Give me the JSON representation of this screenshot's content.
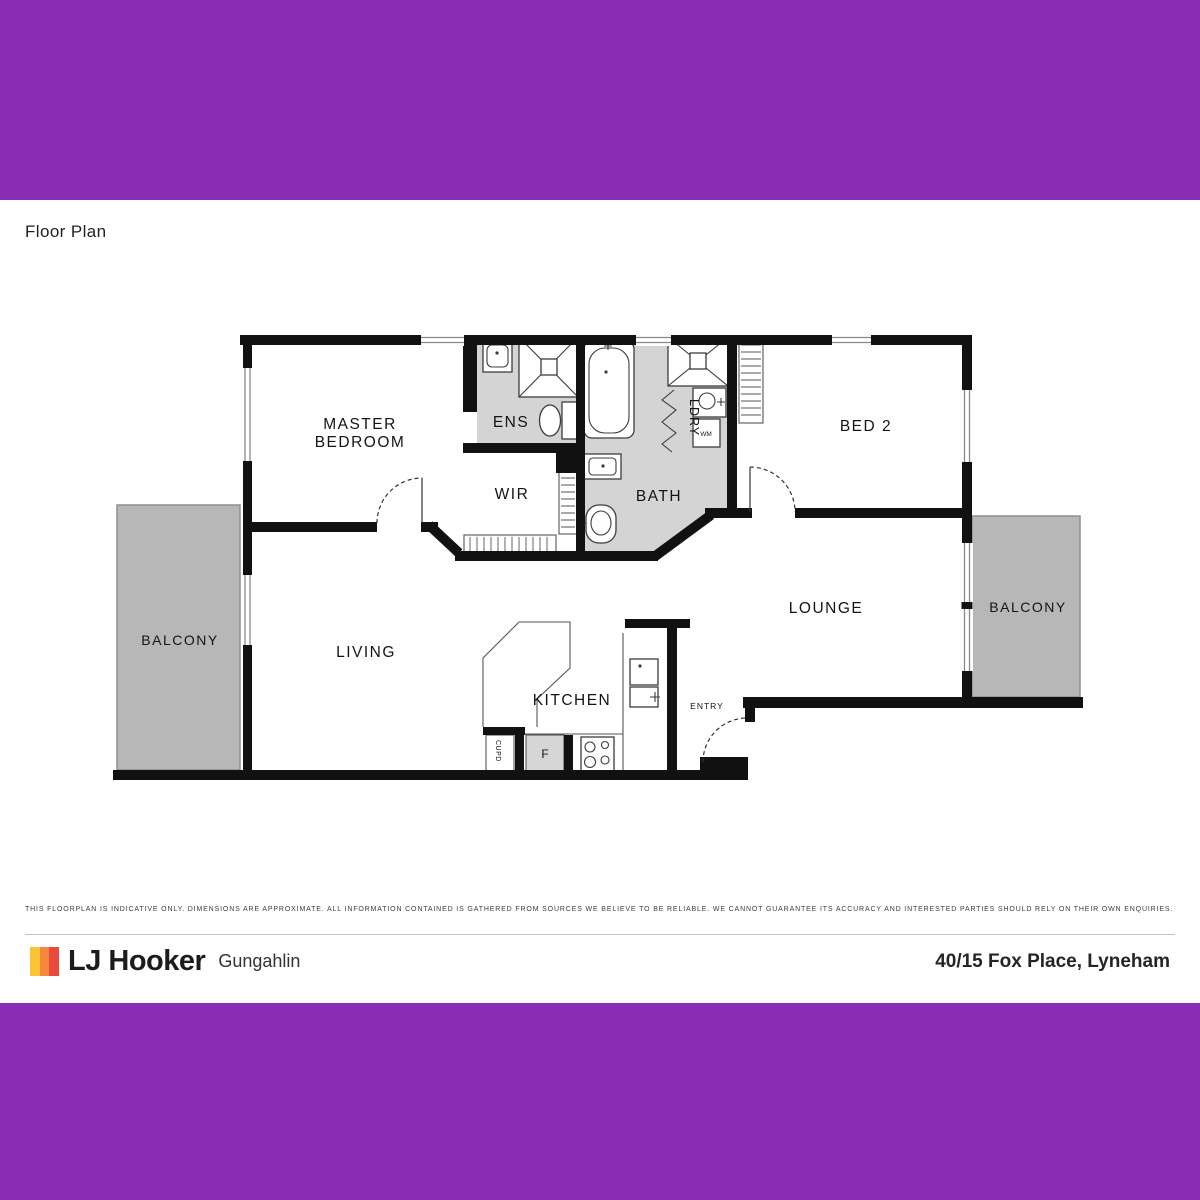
{
  "page": {
    "title": "Floor Plan"
  },
  "plan": {
    "labels": {
      "master_line1": "MASTER",
      "master_line2": "BEDROOM",
      "ens": "ENS",
      "wir": "WIR",
      "bath": "BATH",
      "bed2": "BED 2",
      "ldry": "LDRY",
      "wm": "WM",
      "lounge": "LOUNGE",
      "balcony": "BALCONY",
      "living": "LIVING",
      "kitchen": "KITCHEN",
      "entry": "ENTRY",
      "cupd": "CUPD",
      "fridge": "F"
    }
  },
  "footer": {
    "disclaimer": "THIS FLOORPLAN IS INDICATIVE ONLY. DIMENSIONS ARE APPROXIMATE. ALL INFORMATION CONTAINED IS GATHERED FROM SOURCES WE BELIEVE TO BE RELIABLE. WE CANNOT GUARANTEE ITS ACCURACY AND INTERESTED PARTIES SHOULD RELY ON THEIR OWN ENQUIRIES.",
    "brand": "LJ Hooker",
    "office": "Gungahlin",
    "address": "40/15 Fox Place, Lyneham"
  },
  "colors": {
    "purple": "#8a2db5",
    "wet_area": "#d4d4d4",
    "balcony": "#b7b7b7",
    "wall": "#111111",
    "logo_yellow": "#f9c333",
    "logo_orange": "#f4873c",
    "logo_red": "#e94a3d"
  }
}
